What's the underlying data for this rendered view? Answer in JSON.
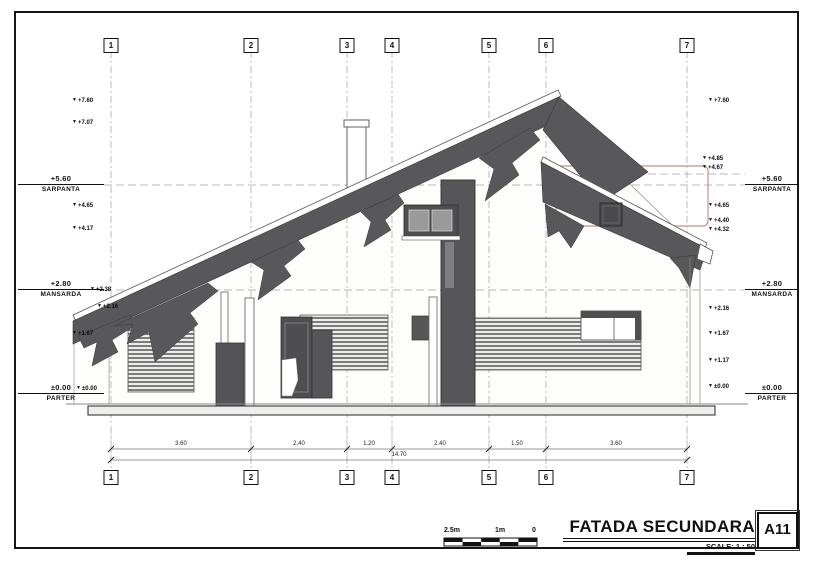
{
  "sheet": {
    "title": "FATADA SECUNDARA",
    "number": "A11",
    "scale_label": "SCALE: 1 : 50",
    "scale_bar_labels": [
      "2.5m",
      "1m",
      "0"
    ]
  },
  "grid_columns": [
    "1",
    "2",
    "3",
    "4",
    "5",
    "6",
    "7"
  ],
  "levels": [
    {
      "value": "+5.60",
      "name": "SARPANTA"
    },
    {
      "value": "+2.80",
      "name": "MANSARDA"
    },
    {
      "value": "±0.00",
      "name": "PARTER"
    }
  ],
  "elevation_markers": {
    "left": [
      "+7.60",
      "+7.07",
      "+4.65",
      "+4.17",
      "+2.38",
      "+2.16",
      "+1.67",
      "±0.00"
    ],
    "right": [
      "+7.60",
      "+4.85",
      "+4.67",
      "+4.65",
      "+4.40",
      "+4.32",
      "+2.16",
      "+1.67",
      "+1.17",
      "±0.00"
    ]
  },
  "dimensions": {
    "segments": [
      "3.60",
      "2.40",
      "1.20",
      "2.40",
      "1.50",
      "3.60"
    ],
    "total": "14.70"
  },
  "colors": {
    "roof_fill": "#58585a",
    "line": "#2a2a2a",
    "grid_dash": "#b5b5b5",
    "highlight": "#c89086"
  }
}
